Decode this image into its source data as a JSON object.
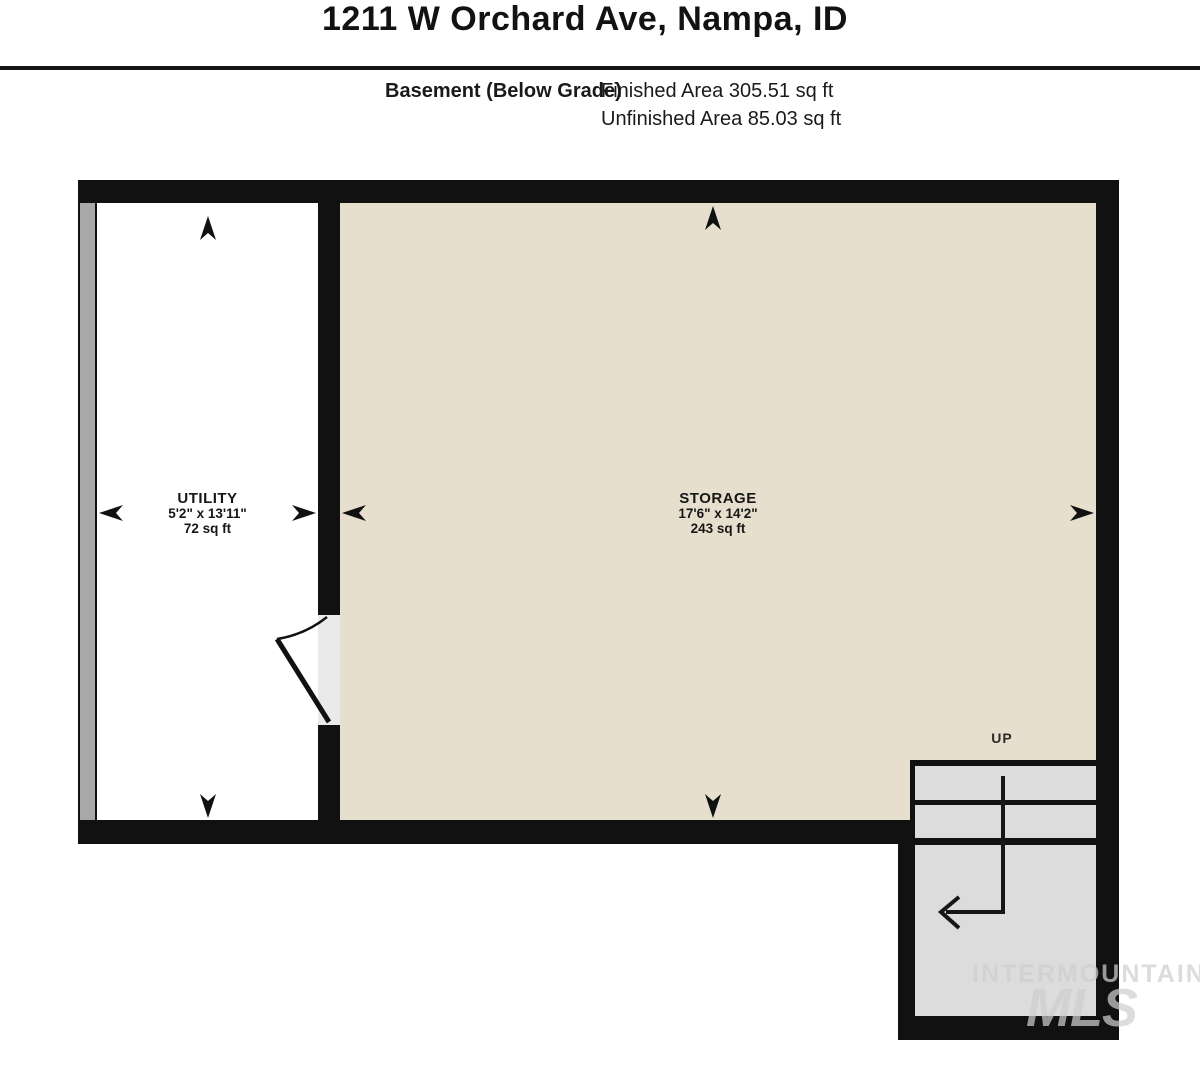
{
  "header": {
    "title": "1211 W Orchard Ave, Nampa, ID",
    "floor_label": "Basement (Below Grade)",
    "finished_area": "Finished Area 305.51 sq ft",
    "unfinished_area": "Unfinished Area 85.03 sq ft"
  },
  "plan": {
    "rooms": [
      {
        "name": "UTILITY",
        "dimensions": "5'2\" x 13'11\"",
        "area": "72 sq ft"
      },
      {
        "name": "STORAGE",
        "dimensions": "17'6\" x 14'2\"",
        "area": "243 sq ft"
      }
    ],
    "stairs": {
      "direction_label": "UP"
    }
  },
  "watermark": {
    "line1": "INTERMOUNTAIN",
    "line2": "MLS"
  },
  "colors": {
    "wall": "#111111",
    "finished_room_fill": "#e7dfcd",
    "unfinished_room_fill": "#ffffff",
    "stair_fill": "#dcdcdc",
    "foundation_strip": "#a8a8a8"
  }
}
